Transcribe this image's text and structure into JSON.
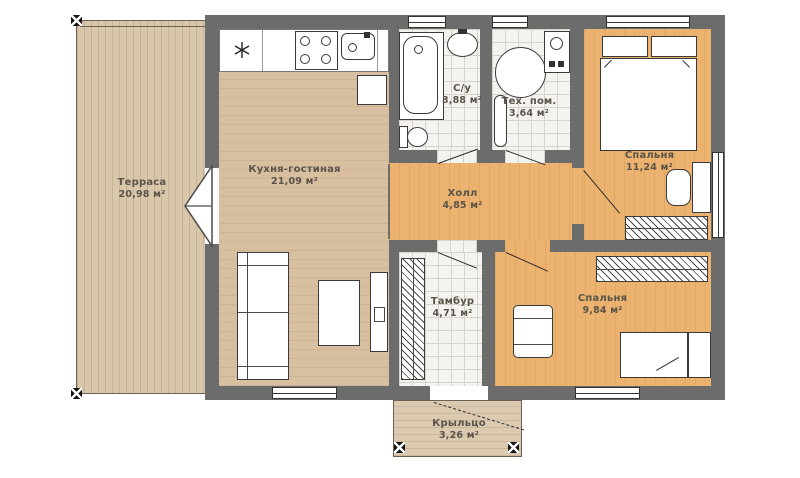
{
  "plan": {
    "rooms": [
      {
        "name": "Терраса",
        "area": "20,98 м²"
      },
      {
        "name": "Кухня-гостиная",
        "area": "21,09 м²"
      },
      {
        "name": "С/у",
        "area": "3,88 м²"
      },
      {
        "name": "Тех. пом.",
        "area": "3,64 м²"
      },
      {
        "name": "Холл",
        "area": "4,85 м²"
      },
      {
        "name": "Спальня",
        "area": "11,24 м²"
      },
      {
        "name": "Спальня",
        "area": "9,84 м²"
      },
      {
        "name": "Тамбур",
        "area": "4,71 м²"
      },
      {
        "name": "Крыльцо",
        "area": "3,26 м²"
      }
    ],
    "colors": {
      "wall": "#6c6c6c",
      "deck_wood": "#d9c7ab",
      "living_wood": "#d7bf9f",
      "bedroom_wood": "#ecb370",
      "tile": "#f4f3f0"
    }
  }
}
